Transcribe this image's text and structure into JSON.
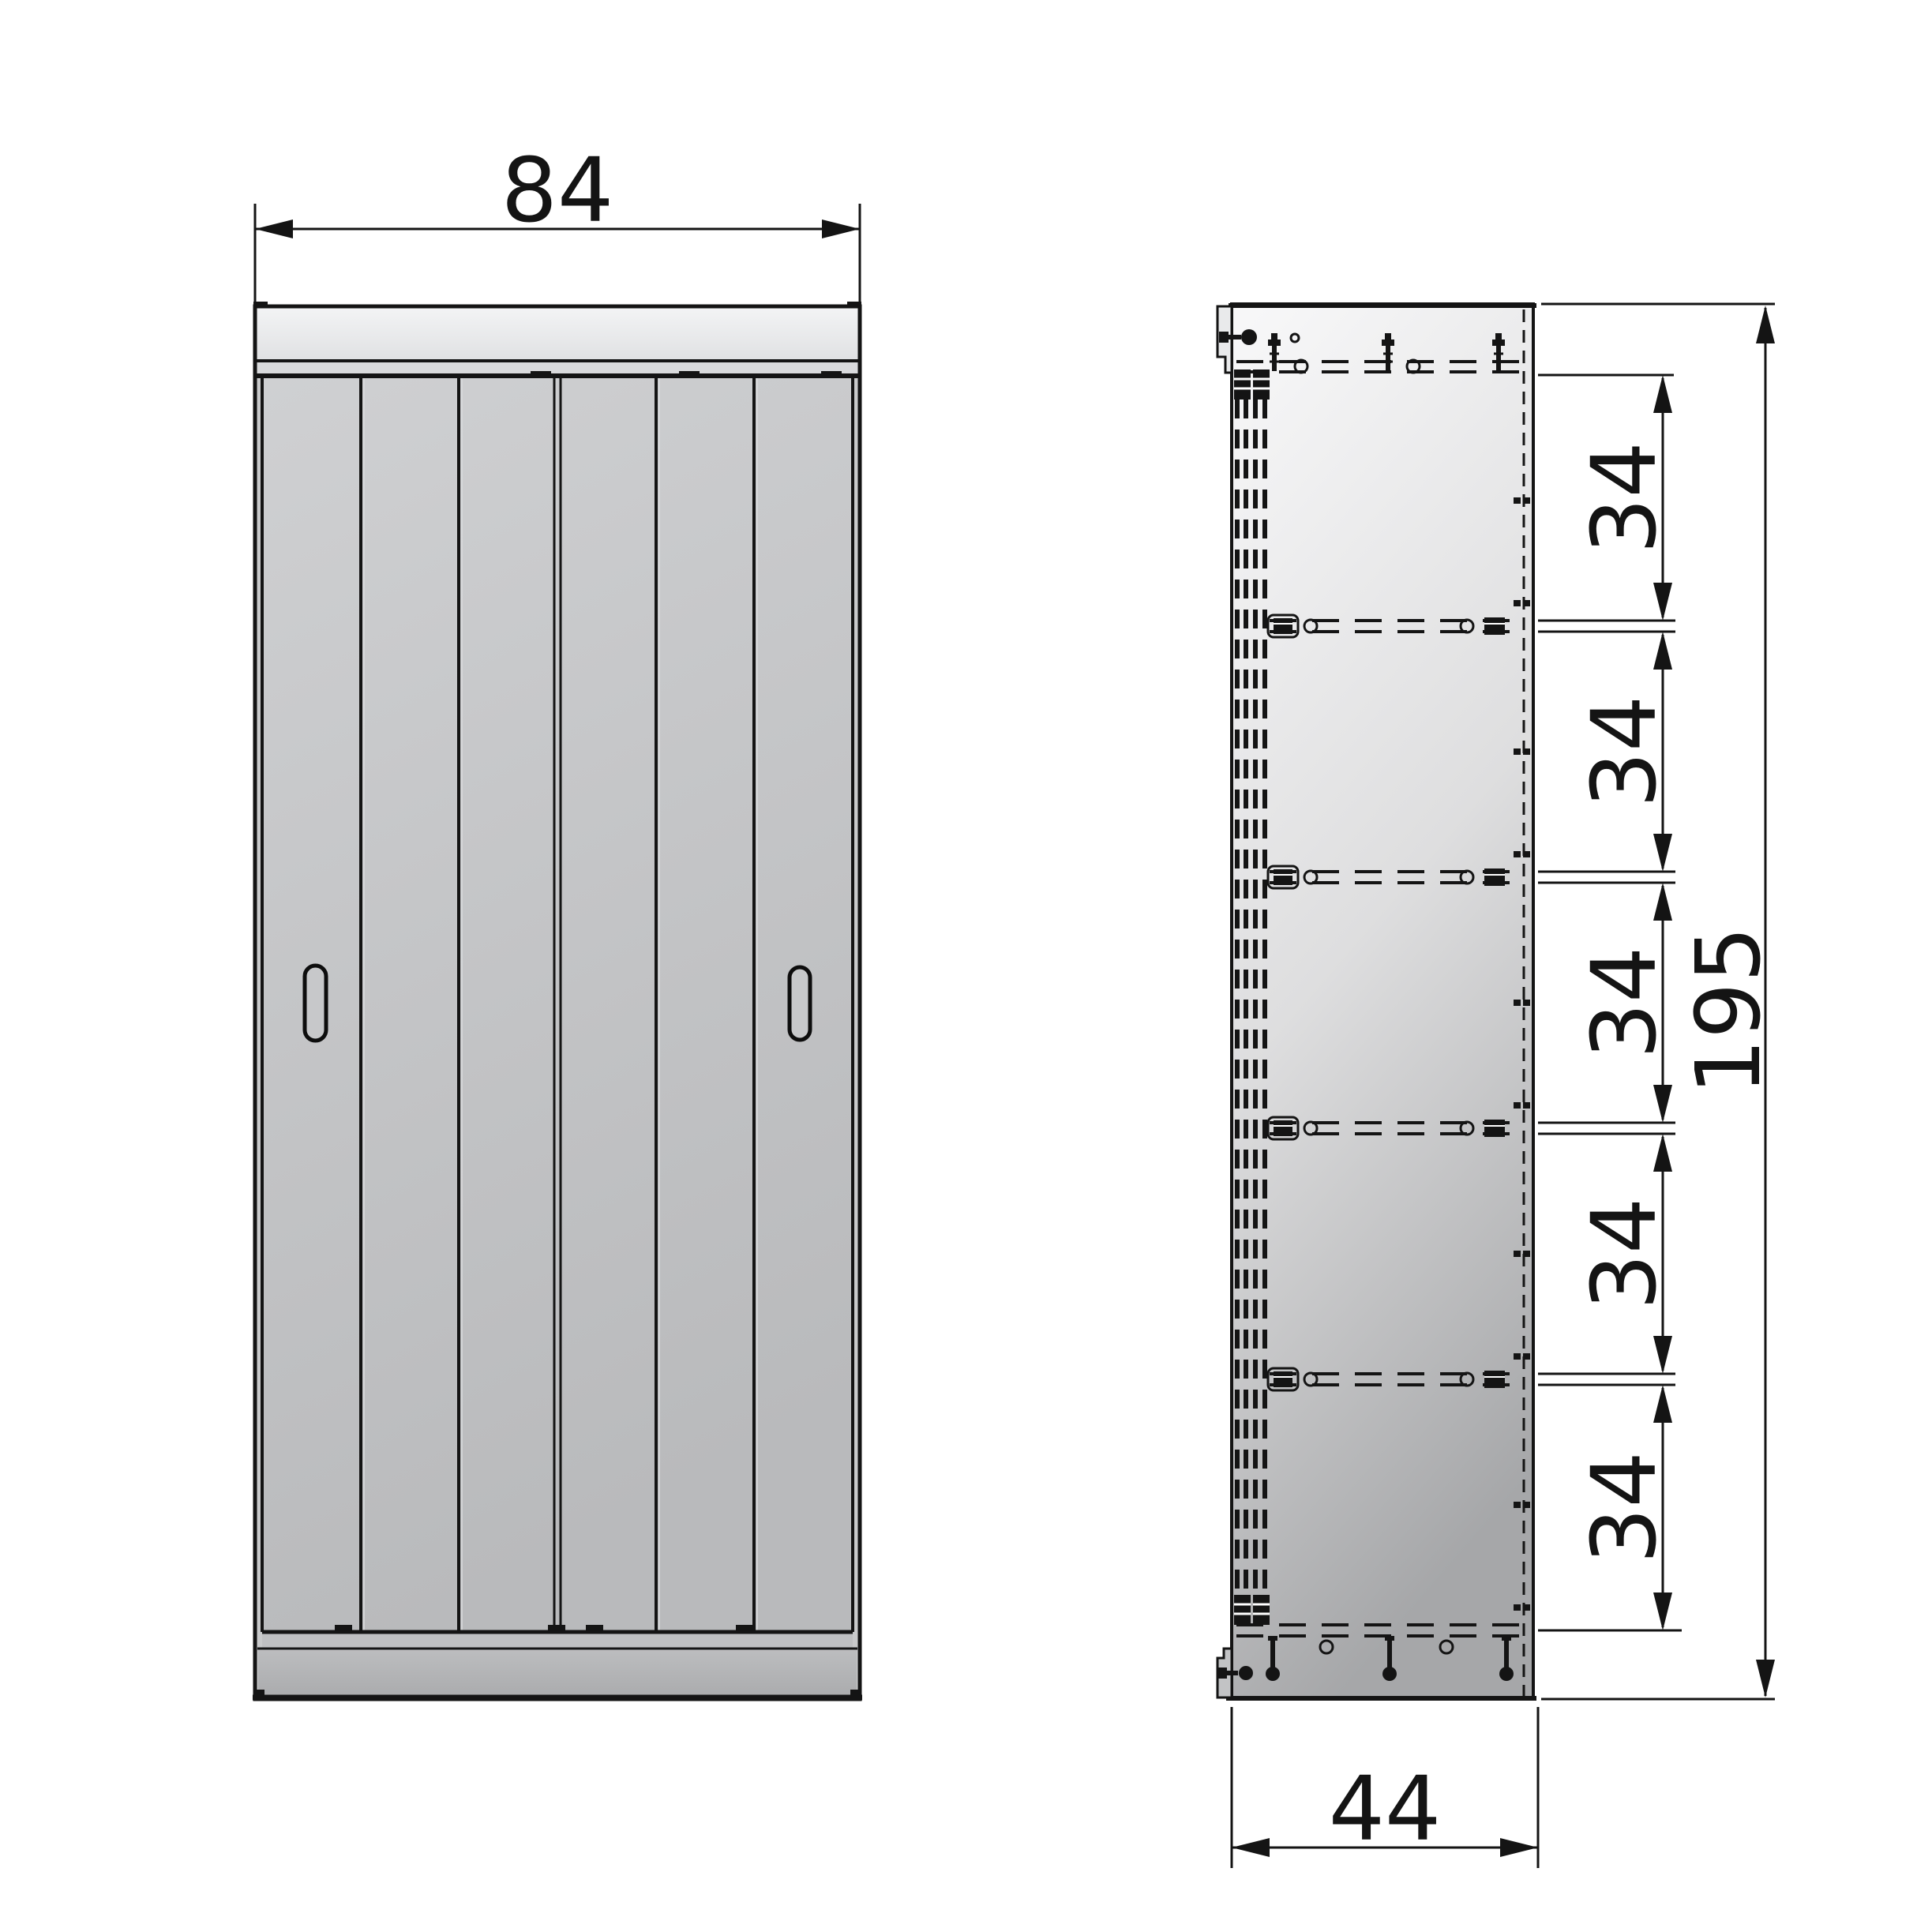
{
  "dimensions": {
    "width": {
      "label": "84",
      "value": 84
    },
    "depth": {
      "label": "44",
      "value": 44
    },
    "height": {
      "label": "195",
      "value": 195
    },
    "shelf_spacings": [
      {
        "label": "34",
        "value": 34
      },
      {
        "label": "34",
        "value": 34
      },
      {
        "label": "34",
        "value": 34
      },
      {
        "label": "34",
        "value": 34
      },
      {
        "label": "34",
        "value": 34
      }
    ]
  },
  "colors": {
    "ink": "#141414",
    "background": "#ffffff",
    "cap_light": "#f2f3f4",
    "door_gray": "#c5c6c8",
    "side_light": "#f6f6f7",
    "side_dark": "#a7a8aa",
    "plinth_gray": "#b1b2b4"
  }
}
